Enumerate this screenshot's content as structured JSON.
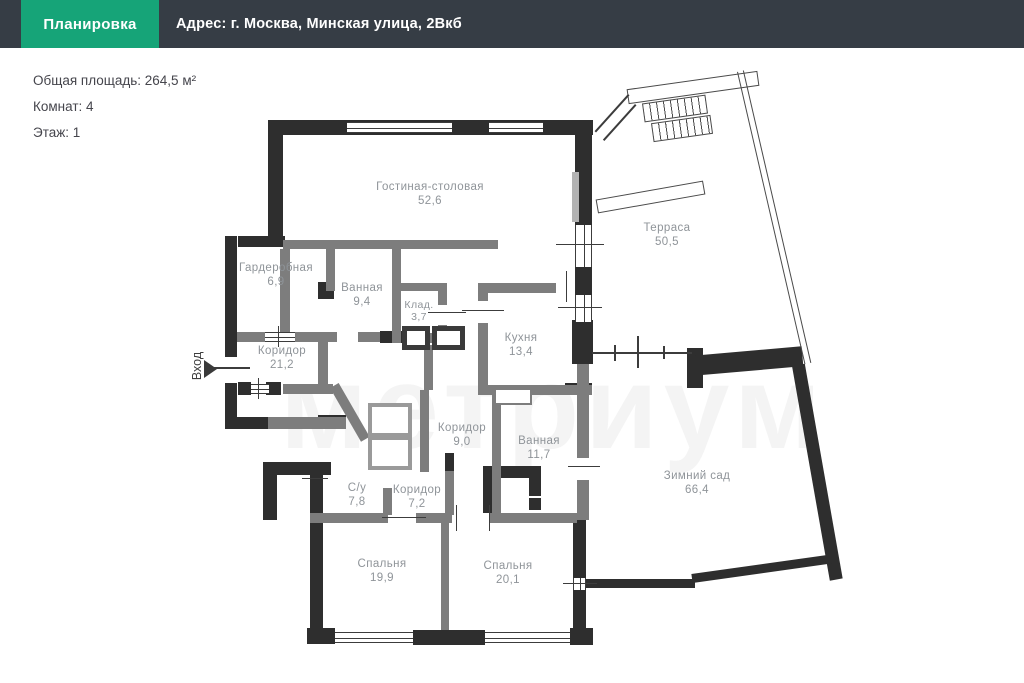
{
  "header": {
    "tab_label": "Планировка",
    "address": "Адрес: г. Москва,  Минская улица, 2Вкб"
  },
  "info": {
    "total_area": "Общая площадь: 264,5 м²",
    "rooms_count": "Комнат: 4",
    "floor": "Этаж: 1"
  },
  "plan": {
    "entrance_label": "Вход",
    "watermark": "метриум",
    "rooms": [
      {
        "name": "Гостиная-столовая",
        "area": "52,6"
      },
      {
        "name": "Гардеробная",
        "area": "6,9"
      },
      {
        "name": "Ванная",
        "area": "9,4"
      },
      {
        "name": "Клад.",
        "area": "3,7"
      },
      {
        "name": "Коридор",
        "area": "21,2"
      },
      {
        "name": "Кухня",
        "area": "13,4"
      },
      {
        "name": "Терраса",
        "area": "50,5"
      },
      {
        "name": "Коридор",
        "area": "9,0"
      },
      {
        "name": "Ванная",
        "area": "11,7"
      },
      {
        "name": "С/у",
        "area": "7,8"
      },
      {
        "name": "Коридор",
        "area": "7,2"
      },
      {
        "name": "Зимний сад",
        "area": "66,4"
      },
      {
        "name": "Спальня",
        "area": "19,9"
      },
      {
        "name": "Спальня",
        "area": "20,1"
      }
    ]
  },
  "colors": {
    "accent_green": "#16a478",
    "header_dark": "#363d45",
    "wall_exterior": "#2e2e2e",
    "wall_interior": "#7d7d7d",
    "label_gray": "#8f9499"
  }
}
